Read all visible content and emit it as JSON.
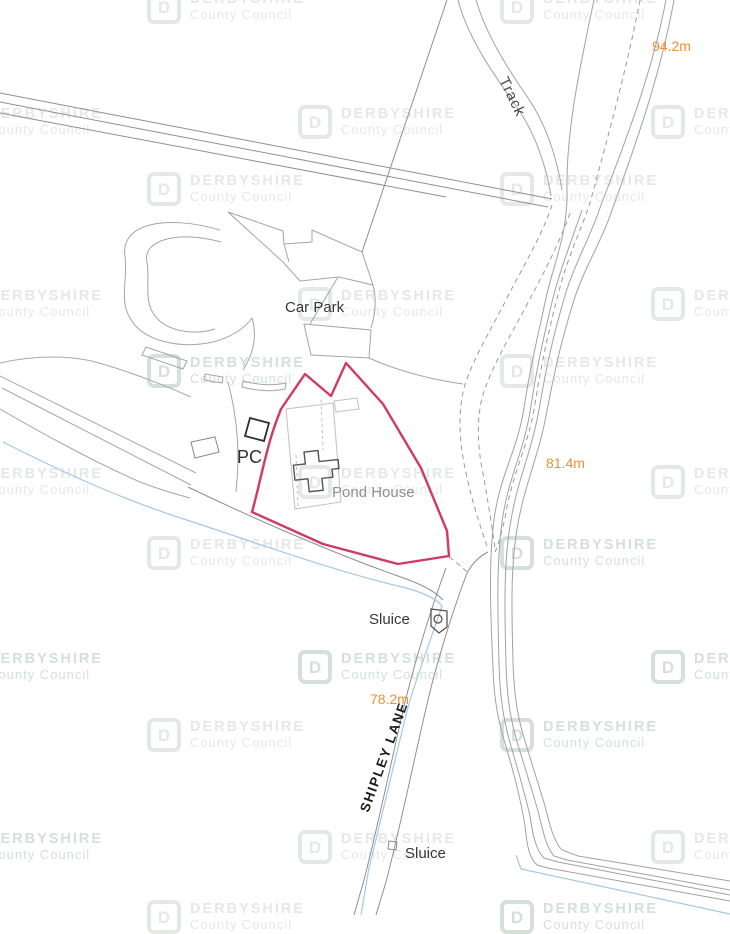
{
  "map": {
    "watermark": {
      "logo_letter": "D",
      "brand": "DERBYSHIRE",
      "subtitle": "County Council"
    },
    "labels": {
      "car_park": "Car Park",
      "pc": "PC",
      "pond_house": "Pond House",
      "sluice_upper": "Sluice",
      "sluice_lower": "Sluice",
      "track": "Track",
      "shipley_lane": "SHIPLEY LANE"
    },
    "elevations": {
      "top_right": "94.2m",
      "middle_right": "81.4m",
      "lower_middle": "78.2m"
    },
    "colors": {
      "site_boundary": "#d13a65",
      "elevation_text": "#ee8f33",
      "water_line": "#a4c9e6",
      "map_line": "#a2a2a2",
      "dark_feature": "#4a4a4a",
      "label_dark": "#383838",
      "label_gray": "#8f8f8f",
      "watermark": "#e4e9e6"
    }
  }
}
